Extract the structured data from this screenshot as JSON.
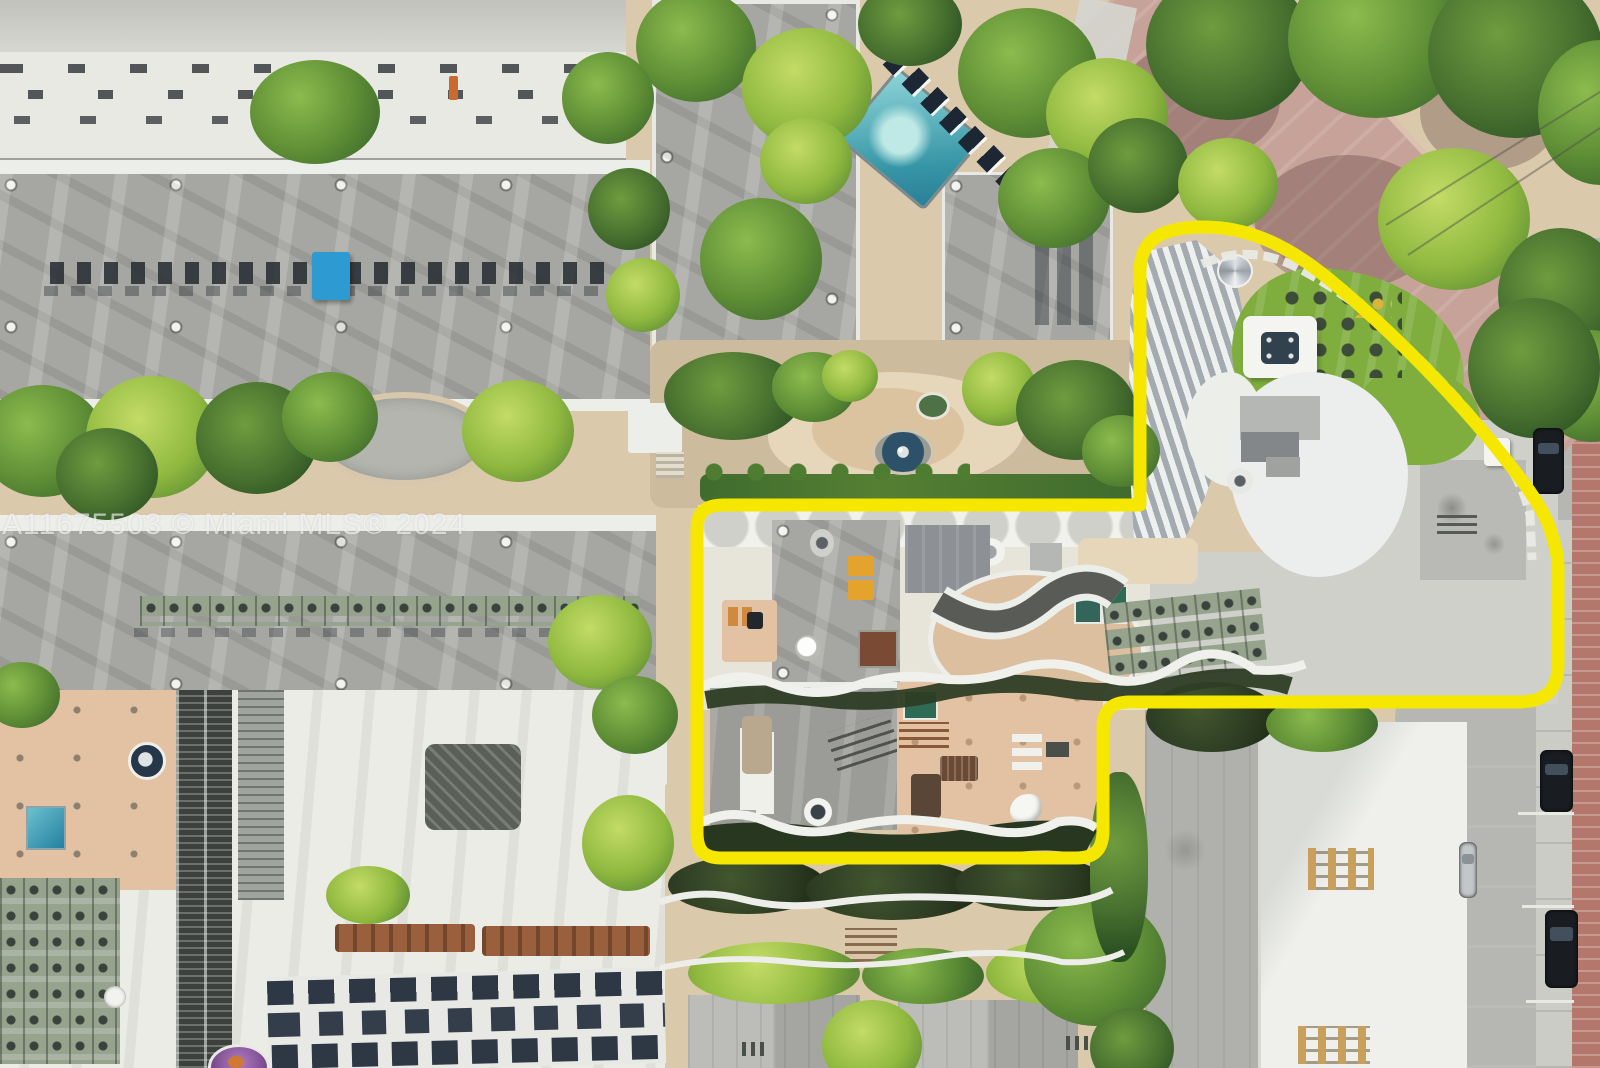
{
  "watermark": {
    "text": "A11675503 © Miami MLS® 2024"
  },
  "property_outline": {
    "color": "#F5E700",
    "width": "13"
  },
  "palette": {
    "sand": "#dbc9ac",
    "sand-light": "#e6d6ba",
    "deck-salmon": "#e2c2a2",
    "roof-gray": "#a6a7a2",
    "roof-white": "#ecece7",
    "pool-teal": "#3f9fae",
    "pool-deep": "#1f7394",
    "turf": "#7fae3e",
    "hedge": "#2c3b22",
    "street": "#b6b7b2",
    "sidewalk": "#cbccc6",
    "brick": "#b3776b",
    "road-pink": "#c7a298",
    "ac-sage": "#97a48d",
    "rust": "#9a5f3c",
    "tarp-blue": "#2e9ad2"
  }
}
